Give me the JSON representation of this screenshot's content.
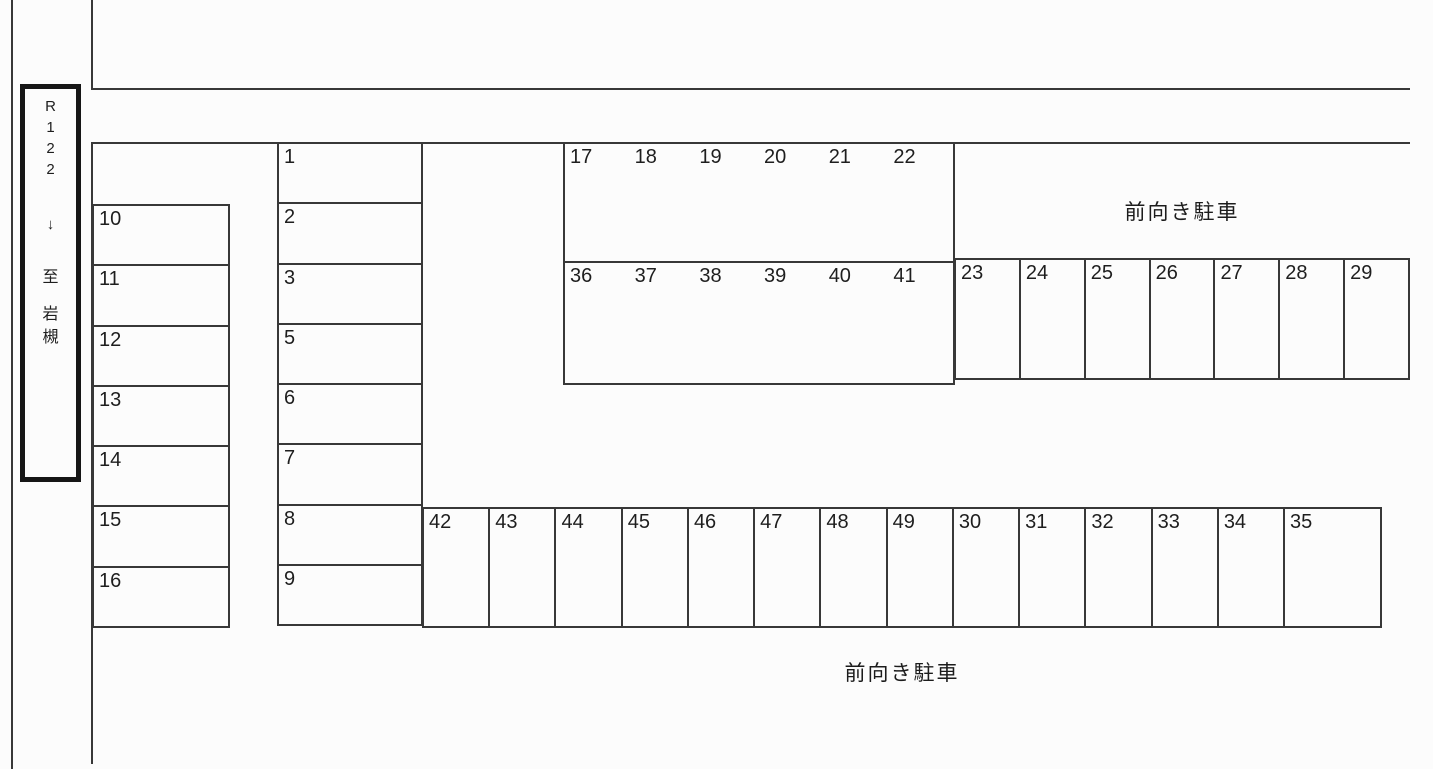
{
  "canvas": {
    "width": 1433,
    "height": 769,
    "background": "#fcfcfc",
    "line_color": "#383838"
  },
  "road_sign": {
    "route": [
      "R",
      "1",
      "2",
      "2"
    ],
    "arrow": "↓",
    "destination": [
      "至",
      "岩",
      "槻"
    ]
  },
  "labels": {
    "front_parking_top": "前向き駐車",
    "front_parking_bottom": "前向き駐車"
  },
  "parking_spaces": {
    "left_column": [
      "10",
      "11",
      "12",
      "13",
      "14",
      "15",
      "16"
    ],
    "inner_column": [
      "1",
      "2",
      "3",
      "5",
      "6",
      "7",
      "8",
      "9"
    ],
    "upper_row": [
      "17",
      "18",
      "19",
      "20",
      "21",
      "22"
    ],
    "middle_row_left": [
      "36",
      "37",
      "38",
      "39",
      "40",
      "41"
    ],
    "middle_row_right": [
      "23",
      "24",
      "25",
      "26",
      "27",
      "28",
      "29"
    ],
    "bottom_row": [
      "42",
      "43",
      "44",
      "45",
      "46",
      "47",
      "48",
      "49",
      "30",
      "31",
      "32",
      "33",
      "34",
      "35"
    ]
  }
}
